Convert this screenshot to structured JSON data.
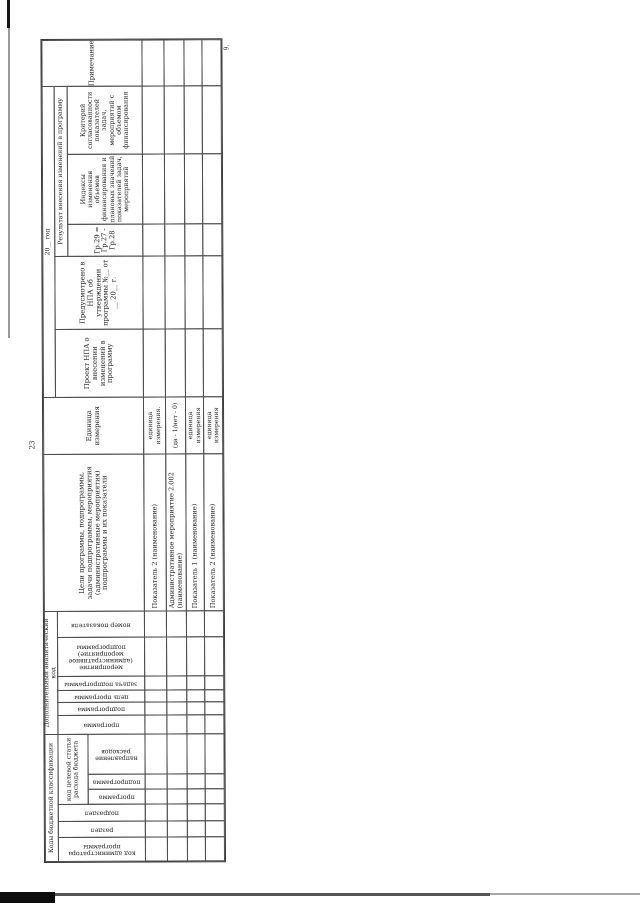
{
  "page": {
    "page_number": "23",
    "footnote_mark": "9."
  },
  "table": {
    "groups": {
      "budget_codes": "Коды бюджетной классификации",
      "target_article": "код целевой статьи расхода бюджета",
      "analytic_code": "Дополнительный аналитический код",
      "year": "20__ год",
      "result": "Результат внесения изменений в программу"
    },
    "columns": {
      "admin_code": "код администратора программы",
      "razdel": "раздел",
      "podrazdel": "подраздел",
      "programma_cs": "программа",
      "podprogramma_cs": "подпрограмма",
      "napravlenie": "направление расходов",
      "programma_ak": "программа",
      "podprogramma_ak": "подпрограмма",
      "tsel_programmy": "цель программы",
      "zadacha_podprogrammy": "задача подпрограммы",
      "meropriyatie": "мероприятие (административное мероприятие) подпрограммы",
      "nomer_pokazatelya": "номер показателя",
      "goals": "Цели программы, подпрограммы, задачи подпрограммы, мероприятия (административные мероприятия) подпрограммы и их показатели",
      "unit": "Единица измерения",
      "project_npa": "Проект НПА о внесении изменений в программу",
      "provided_npa": "Предусмотрено в НПА об утверждении программы №__ от __ 20__ г.",
      "gr_formula": "Гр.29 = Гр.27 - Гр.28",
      "indexes": "Индексы изменения объемов финансирования и плановых значений показателей задач, мероприятий",
      "criterion": "Критерий согласованности показателей задач, мероприятий с объемом финансирования",
      "note": "Примечание"
    },
    "rows": [
      {
        "label": "Показатель 2 (наименование)",
        "unit": "единица измерения."
      },
      {
        "label": "Административное мероприятие 2.002 (наименование)",
        "unit": "(да - 1/нет - 0)"
      },
      {
        "label": "Показатель 1 (наименование)",
        "unit": "единица измерения"
      },
      {
        "label": "Показатель 2 (наименование)",
        "unit": "единица измерения"
      }
    ]
  }
}
